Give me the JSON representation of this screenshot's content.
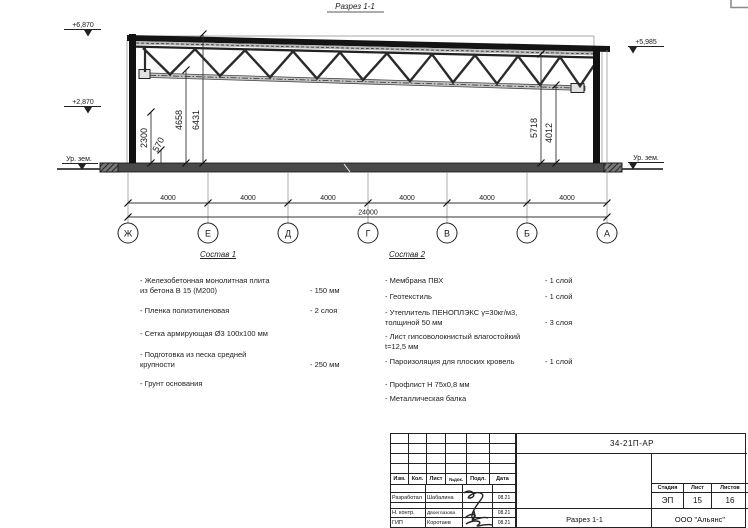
{
  "drawing": {
    "section_title": "Разрез 1-1",
    "elev_top_left": "+6,870",
    "elev_mid_left": "+2,870",
    "elev_top_right": "+5,985",
    "ground_left": "Ур. зем.",
    "ground_right": "Ур. зем.",
    "vdims": {
      "h2300": "2300",
      "h570": "570",
      "h4658": "4658",
      "h6431": "6431",
      "h5718": "5718",
      "h4012": "4012"
    },
    "bays": [
      "4000",
      "4000",
      "4000",
      "4000",
      "4000",
      "4000"
    ],
    "total": "24000",
    "axes": [
      "Ж",
      "Е",
      "Д",
      "Г",
      "В",
      "Б",
      "А"
    ]
  },
  "sostav1": {
    "title": "Состав 1",
    "items": [
      {
        "name": "- Железобетонная  монолитная плита\nиз бетона В 15 (М200)",
        "value": "- 150 мм"
      },
      {
        "name": "- Пленка полиэтиленовая",
        "value": "- 2 слоя"
      },
      {
        "name": "- Сетка армирующая Ø3 100х100 мм",
        "value": ""
      },
      {
        "name": "- Подготовка из песка средней\nкрупности",
        "value": "- 250 мм"
      },
      {
        "name": "- Грунт основания",
        "value": ""
      }
    ]
  },
  "sostav2": {
    "title": "Состав 2",
    "items": [
      {
        "name": "- Мембрана ПВХ",
        "value": "- 1 слой"
      },
      {
        "name": "- Геотекстиль",
        "value": "- 1 слой"
      },
      {
        "name": "- Утеплитель ПЕНОПЛЭКС γ=30кг/м3,\nтолщиной 50 мм",
        "value": "- 3 слоя"
      },
      {
        "name": "- Лист гипсоволокнистый влагостойкий\nt=12,5 мм",
        "value": ""
      },
      {
        "name": "- Пароизоляция для плоских кровель",
        "value": "- 1 слой"
      },
      {
        "name": "- Профлист Н 75х0,8 мм",
        "value": ""
      },
      {
        "name": "- Металлическая балка",
        "value": ""
      }
    ]
  },
  "titleblock": {
    "doc_number": "34-21П-АР",
    "rev_headers": [
      "Изм.",
      "Кол.",
      "Лист",
      "№док.",
      "Подл.",
      "Дата"
    ],
    "sign_rows": [
      {
        "role": "Разработал",
        "name": "Шабалина",
        "date": "08.21"
      },
      {
        "role": "Н. контр.",
        "name": "Двоеглазова",
        "date": "08.21"
      },
      {
        "role": "ГИП",
        "name": "Коротаев",
        "date": "08.21"
      }
    ],
    "stage_label": "Стадия",
    "sheet_label": "Лист",
    "sheets_label": "Листов",
    "stage": "ЭП",
    "sheet_num": "15",
    "sheets_total": "16",
    "drawing_name": "Разрез 1-1",
    "company": "ООО \"Альянс\""
  }
}
